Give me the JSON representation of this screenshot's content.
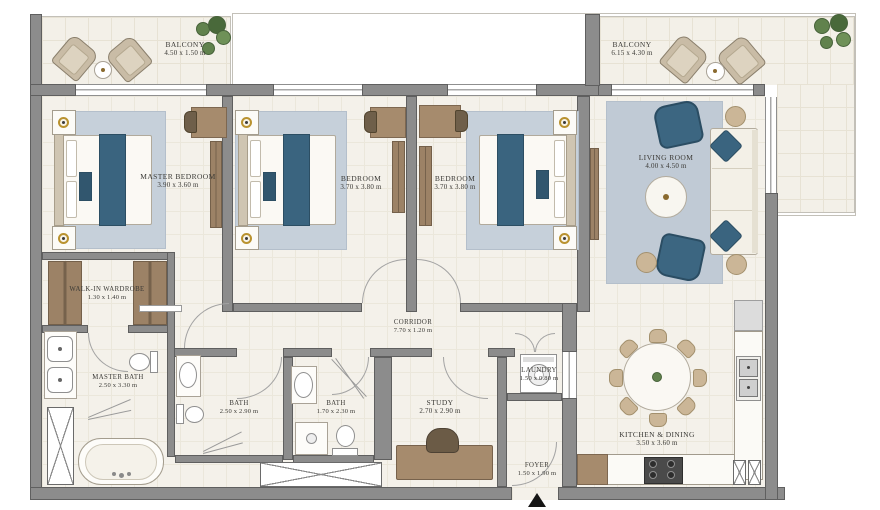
{
  "floorplan": {
    "rooms": [
      {
        "id": "balcony-left",
        "name": "BALCONY",
        "dims": "4.50 x 1.50 m"
      },
      {
        "id": "balcony-right",
        "name": "BALCONY",
        "dims": "6.15 x 4.30 m"
      },
      {
        "id": "master-bedroom",
        "name": "MASTER BEDROOM",
        "dims": "3.90 x 3.60 m"
      },
      {
        "id": "bedroom-2",
        "name": "BEDROOM",
        "dims": "3.70 x 3.80 m"
      },
      {
        "id": "bedroom-3",
        "name": "BEDROOM",
        "dims": "3.70 x 3.80 m"
      },
      {
        "id": "living-room",
        "name": "LIVING ROOM",
        "dims": "4.00 x 4.50 m"
      },
      {
        "id": "walk-in-wardrobe",
        "name": "WALK-IN WARDROBE",
        "dims": "1.30 x 1.40 m"
      },
      {
        "id": "master-bath",
        "name": "MASTER BATH",
        "dims": "2.50 x 3.30 m"
      },
      {
        "id": "corridor",
        "name": "CORRIDOR",
        "dims": "7.70 x 1.20 m"
      },
      {
        "id": "bath-1",
        "name": "BATH",
        "dims": "2.50 x 2.90 m"
      },
      {
        "id": "bath-2",
        "name": "BATH",
        "dims": "1.70 x 2.30 m"
      },
      {
        "id": "study",
        "name": "STUDY",
        "dims": "2.70 x 2.90 m"
      },
      {
        "id": "laundry",
        "name": "LAUNDRY",
        "dims": "1.50 x 0.80 m"
      },
      {
        "id": "foyer",
        "name": "FOYER",
        "dims": "1.50 x 1.90 m"
      },
      {
        "id": "kitchen-dining",
        "name": "KITCHEN & DINING",
        "dims": "3.50 x 3.60 m"
      }
    ],
    "colors": {
      "wall": "#8c8c8c",
      "floor": "#f4f1ea",
      "balcony_floor": "#f3f0e8",
      "rug": "#c4ced9",
      "accent_blue": "#3a647f",
      "wood": "#a68b6d",
      "tan_fabric": "#cbb697",
      "plant_green": "#61824d",
      "lamp_gold": "#b9922f"
    }
  }
}
